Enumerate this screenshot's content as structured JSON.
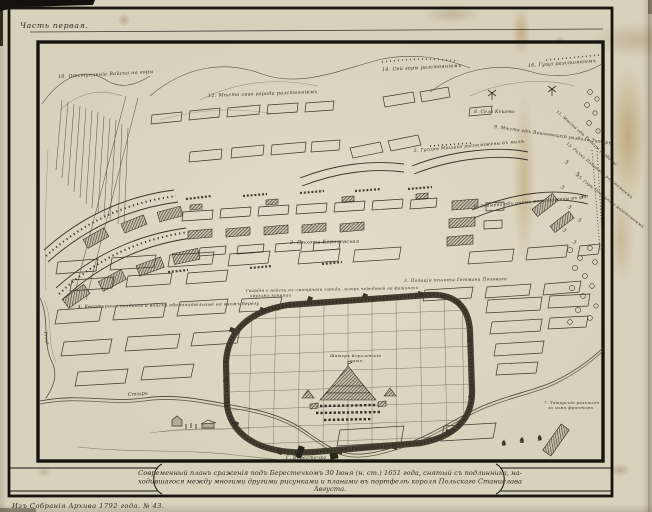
{
  "page": {
    "part_label": "Часть первая.",
    "archive_note": "Изъ Собранія Архива 1792 года. № 43."
  },
  "caption": {
    "line1": "Современный планъ сраженія подъ Берестечкомъ 30 Іюня (н. ст.) 1651 года, снятый съ подлинника, на-",
    "line2": "ходившагося между многими другими рисунками и планами въ портфелѣ короля Польскаго Станислава",
    "line3": "Августа."
  },
  "map": {
    "labels": [
      {
        "text": "10. Отступленіе Войска на горы"
      },
      {
        "text": "12. Мѣсто сего города разстояніемъ"
      },
      {
        "text": "14. Сей горы разстояніемъ"
      },
      {
        "text": "16. Гуща разстояніемъ"
      },
      {
        "text": "8. Село Кошево"
      },
      {
        "text": "9. Мѣсто гдѣ Вишневецкій разбилъ Татаръ"
      },
      {
        "text": "5. Гусары Мнишка расположены въ милѣ"
      },
      {
        "text": "6. Знамена объ ономъ расположены въ ст."
      },
      {
        "text": "2. Пѣхота Королевская"
      },
      {
        "text": "3. Позиція пѣхоты Гетмана Полеваго"
      },
      {
        "text": "4. Квартирные солдаты и войски оборонительные на ономъ берегу"
      },
      {
        "text": "Гвардія и войски въ смотрѣніи города, лагерь передовой на фашинахъ"
      },
      {
        "text": "кругомъ конница"
      },
      {
        "text": "Шатеръ Королевскій"
      },
      {
        "text": "нашъ"
      },
      {
        "text": "Стырь"
      },
      {
        "text": "Рѣка"
      },
      {
        "text": "Г. Берестечко"
      },
      {
        "text": "7. Татарскій разъѣздъ"
      },
      {
        "text": "за симъ фронтомъ"
      },
      {
        "text": "11. Мѣсто гдѣ Татары разбиты"
      },
      {
        "text": "13. Рѣчка Пляшевка разстояніемъ"
      },
      {
        "text": "15. Горы Потоцкаго разстояніемъ"
      }
    ]
  },
  "colors": {
    "paper": "#d8d1bc",
    "ink": "#2e2920",
    "frame": "#17140e",
    "stain": "#b89550"
  }
}
